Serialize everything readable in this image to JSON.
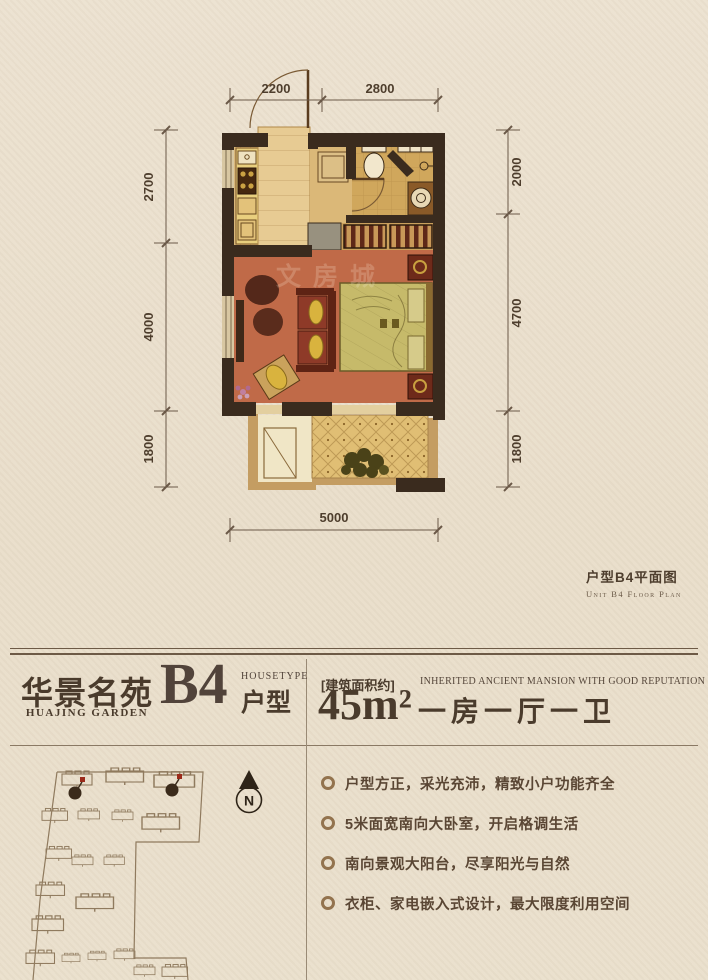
{
  "floor_plan": {
    "caption": "户型B4平面图",
    "caption_en": "Unit B4 Floor Plan",
    "watermark": "文房城",
    "dims": {
      "top": [
        "2200",
        "2800"
      ],
      "left": [
        "2700",
        "4000",
        "1800"
      ],
      "right": [
        "2000",
        "4700",
        "1800"
      ],
      "bottom": [
        "5000"
      ]
    }
  },
  "header": {
    "brand": "华景名苑",
    "brand_en": "HUAJING GARDEN",
    "unit_code": "B4",
    "housetype_en": "HOUSETYPE",
    "housetype": "户型",
    "area_label": "[建筑面积约]",
    "area_value": "45m²",
    "slogan_en": "INHERITED ANCIENT MANSION WITH GOOD REPUTATION",
    "layout": "一房一厅一卫"
  },
  "features": [
    {
      "text": "户型方正，采光充沛，精致小户功能齐全"
    },
    {
      "text": "5米面宽南向大卧室，开启格调生活"
    },
    {
      "text": "南向景观大阳台，尽享阳光与自然"
    },
    {
      "text": "衣柜、家电嵌入式设计，最大限度利用空间"
    }
  ],
  "site_plan": {
    "north_label": "N"
  },
  "colors": {
    "wall": "#3a2b1e",
    "living_floor": "#c06a48",
    "accent_red": "#8e3a28",
    "line": "#6b5948",
    "paper": "#e9decb"
  }
}
